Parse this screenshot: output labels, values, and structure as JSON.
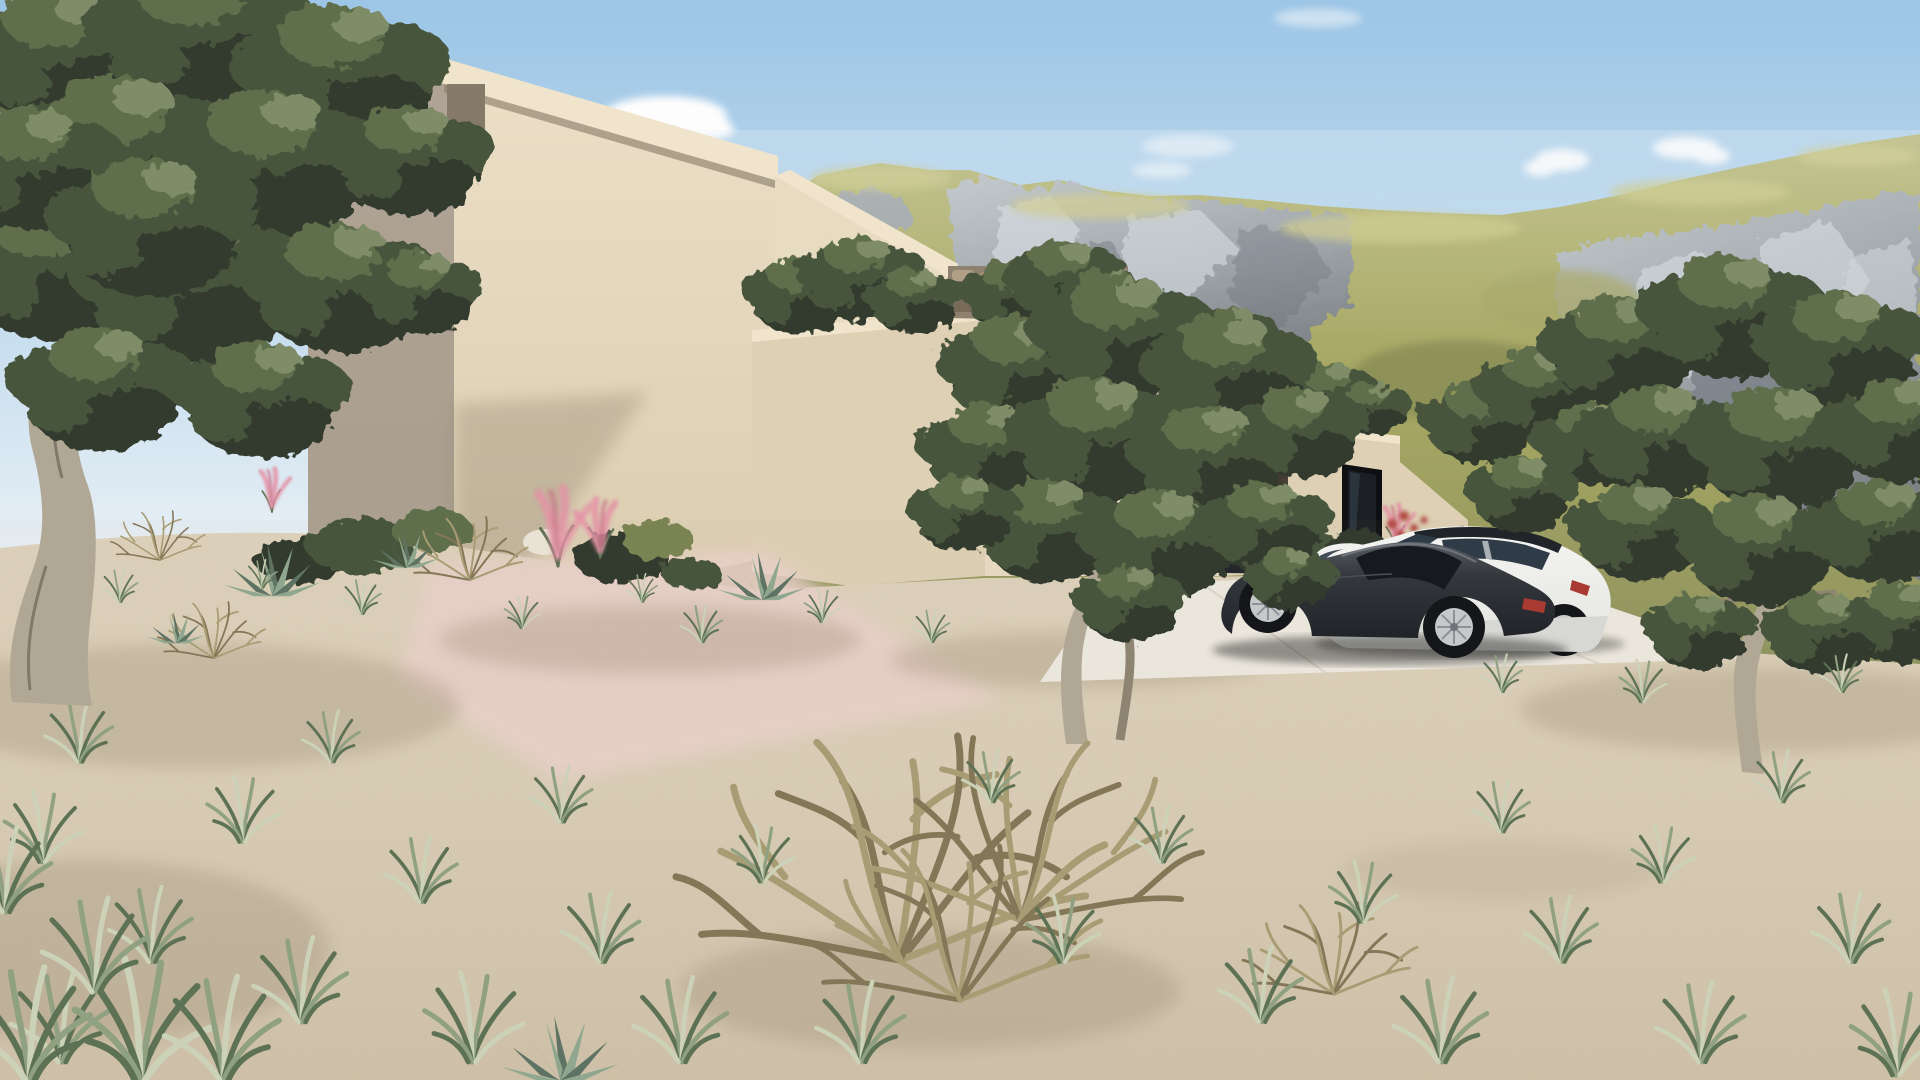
{
  "scene": {
    "description": "Photorealistic 3D exterior rendering of a modern flat-roofed beige villa in a dry Mediterranean landscape: stepped cubic volumes descending to the right, roof-terrace olive trees, a rubble stone wall, a dark garage opening and a dark-framed window. A dark sports sedan, a white estate car with black roof and a small white compact are parked on a light concrete driveway. Gnarled olive trees frame the view, sandy ground with tufted grass, agaves, pink muhly grass and a dry twiggy bush fill the foreground. Rocky grass-covered mountains rise under a pale blue sky with small white clouds.",
    "time_of_day": "sunny day",
    "sky": {
      "cloud_count": 5
    },
    "mountains": {
      "type": "limestone crags with yellow-green grass slopes",
      "ridges": 2
    },
    "house": {
      "style": "modern minimalist stucco villa",
      "stepped_volumes": 6,
      "features": [
        "cantilevered flat roof slab with notch",
        "roof-terrace olive trees",
        "rubble stone wall",
        "recessed dark garage opening",
        "dark framed window",
        "diagonal light shadow on facade"
      ]
    },
    "vehicles": [
      {
        "name": "dark sports sedan",
        "body_color_key": "car_dark"
      },
      {
        "name": "white estate car with black roof",
        "body_color_key": "car_white"
      },
      {
        "name": "white compact car",
        "body_color_key": "car_white"
      }
    ],
    "vegetation": {
      "olive_trees_foreground": 3,
      "olive_trees_rooftop_clusters": 4,
      "grass_tufts": "scattered across sandy ground",
      "agaves": 5,
      "pink_muhly_clusters": 4,
      "dry_bushes": 5,
      "shrubs_along_house_base": 9
    }
  },
  "colors": {
    "sky_top": "#9cc5e6",
    "sky_mid": "#c3dcee",
    "sky_horizon": "#e9f0f5",
    "cloud_white": "#fdfdfd",
    "mtn_grass_hi": "#c9c57f",
    "mtn_grass": "#a4a562",
    "mtn_grass_dk": "#868b55",
    "rock_light": "#ccd1d7",
    "rock_mid": "#9ba2ab",
    "rock_dark": "#6e747c",
    "haze": "#eaf1f6",
    "wall_lit": "#e7dbc2",
    "wall_mid": "#ddd0b4",
    "wall_bright": "#f0e5cc",
    "wall_shade": "#998f83",
    "under_slab": "#857a68",
    "opening_dark": "#1b1e22",
    "opening_glass": "#2e3945",
    "frame_dark": "#0d0f12",
    "stone_base": "#8e8170",
    "stone_a": "#b4a289",
    "stone_b": "#9c8a70",
    "stone_c": "#756955",
    "drive": "#eae6dc",
    "drive_edge": "#d3cec1",
    "sand_light": "#ead0ca",
    "sand": "#d9cdb6",
    "sand_dark": "#c2b49b",
    "sand_shadow": "#9c8d74",
    "grass_b1": "#5d7254",
    "grass_b2": "#8fa181",
    "grass_b3": "#cbd2b8",
    "olive_dark": "#303b2d",
    "olive_mid": "#47553d",
    "olive_light": "#5f6e4b",
    "olive_hi": "#7e8d67",
    "trunk_light": "#b0a795",
    "trunk_mid": "#8d8472",
    "trunk_dark": "#615a4e",
    "dry_a": "#a89c74",
    "dry_b": "#837757",
    "pink": "#e492a6",
    "pink_deep": "#c96e85",
    "red_fl": "#b0473f",
    "agave_a": "#5f7365",
    "agave_b": "#8fa78f",
    "car_dark": "#2b2f34",
    "car_dark_hi": "#565b62",
    "car_glass": "#161a1e",
    "rim": "#c6c8ca",
    "wheel_dark": "#141619",
    "tail_red": "#a83a31",
    "car_white": "#f0f0ee",
    "car_white_sh": "#d7d7d3",
    "roof_dark": "#212429",
    "glass_blue": "#2f3b47"
  }
}
